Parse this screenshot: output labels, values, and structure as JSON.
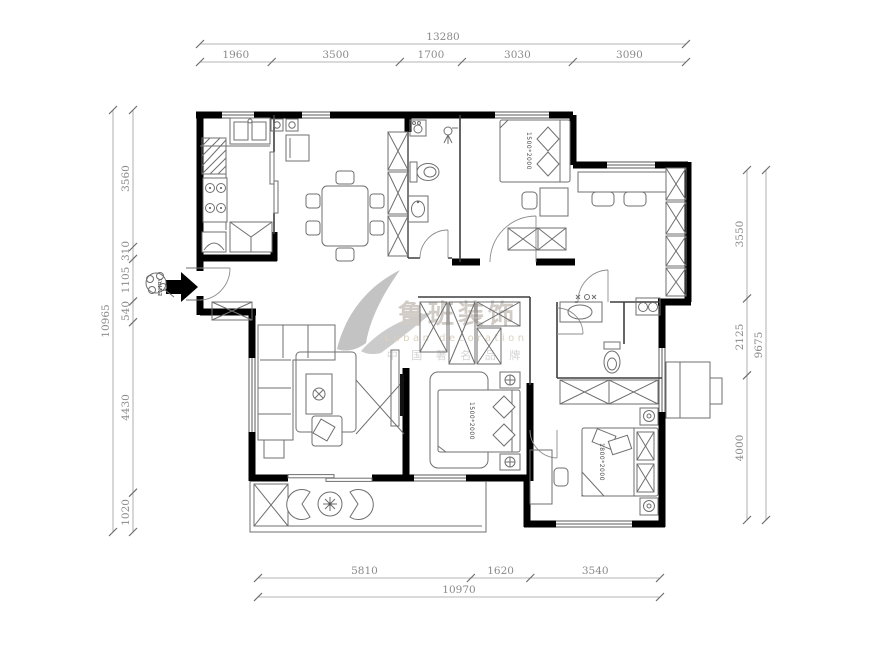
{
  "dimensions": {
    "top": {
      "total": "13280",
      "segments": [
        "1960",
        "3500",
        "1700",
        "3030",
        "3090"
      ]
    },
    "left": {
      "total": "10965",
      "segments": [
        "3560",
        "310",
        "1105",
        "540",
        "4430",
        "1020"
      ]
    },
    "right": {
      "total": "9675",
      "segments": [
        "3550",
        "2125",
        "4000"
      ]
    },
    "bottom": {
      "total": "10970",
      "segments": [
        "5810",
        "1620",
        "3540"
      ]
    }
  },
  "beds": {
    "top_bedroom": "1500*2000",
    "master_bedroom": "1500*2000",
    "corner_bedroom": "1800*2000"
  },
  "entry": {
    "label": "ENTRY"
  },
  "watermark": {
    "brand": "鲁班装饰",
    "brand_en": "Luban decoration",
    "tagline": "中 国 著 名 品 牌"
  }
}
